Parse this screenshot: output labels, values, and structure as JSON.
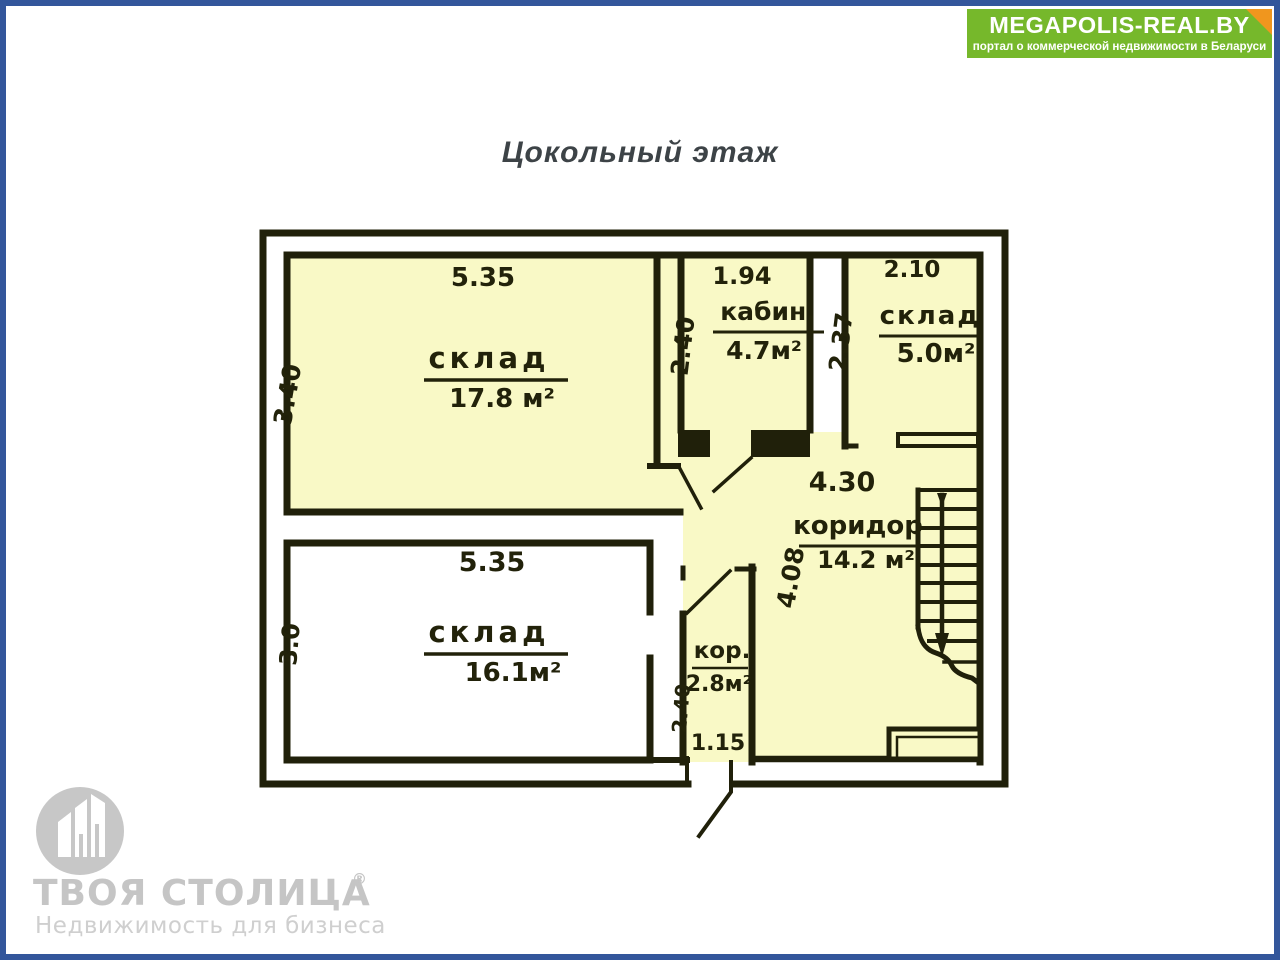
{
  "page": {
    "background_color": "#FFFFFF",
    "border_color": "#33569B"
  },
  "header": {
    "title": "Цокольный этаж"
  },
  "banner": {
    "title": "MEGAPOLIS-REAL.BY",
    "subtitle": "портал о коммерческой недвижимости в Беларуси",
    "bg_color": "#76B82B",
    "fold_color": "#F0961E",
    "text_color": "#FFFFFF"
  },
  "floor_plan": {
    "fill_color": "#F9F9C6",
    "wall_color": "#20200a",
    "rooms": [
      {
        "name": "склад",
        "area": "17.8 м²",
        "width_label": "5.35",
        "height_label": "3.40"
      },
      {
        "name": "кабин.",
        "area": "4.7м²",
        "width_label": "1.94",
        "height_label": "2.40"
      },
      {
        "name": "склад",
        "area": "5.0м²",
        "width_label": "2.10",
        "height_label": "2.37"
      },
      {
        "name": "коридор",
        "area": "14.2 м²",
        "width_label": "4.30",
        "height_label": "4.08"
      },
      {
        "name": "склад",
        "area": "16.1м²",
        "width_label": "5.35",
        "height_label": "3.0"
      },
      {
        "name": "кор.",
        "area": "2.8м²",
        "width_label": "1.15",
        "height_label": "2.40"
      }
    ]
  },
  "footer_logo": {
    "name": "ТВОЯ СТОЛИЦА",
    "reg_mark": "®",
    "tagline": "Недвижимость для бизнеса",
    "color": "#C6C6C6"
  }
}
